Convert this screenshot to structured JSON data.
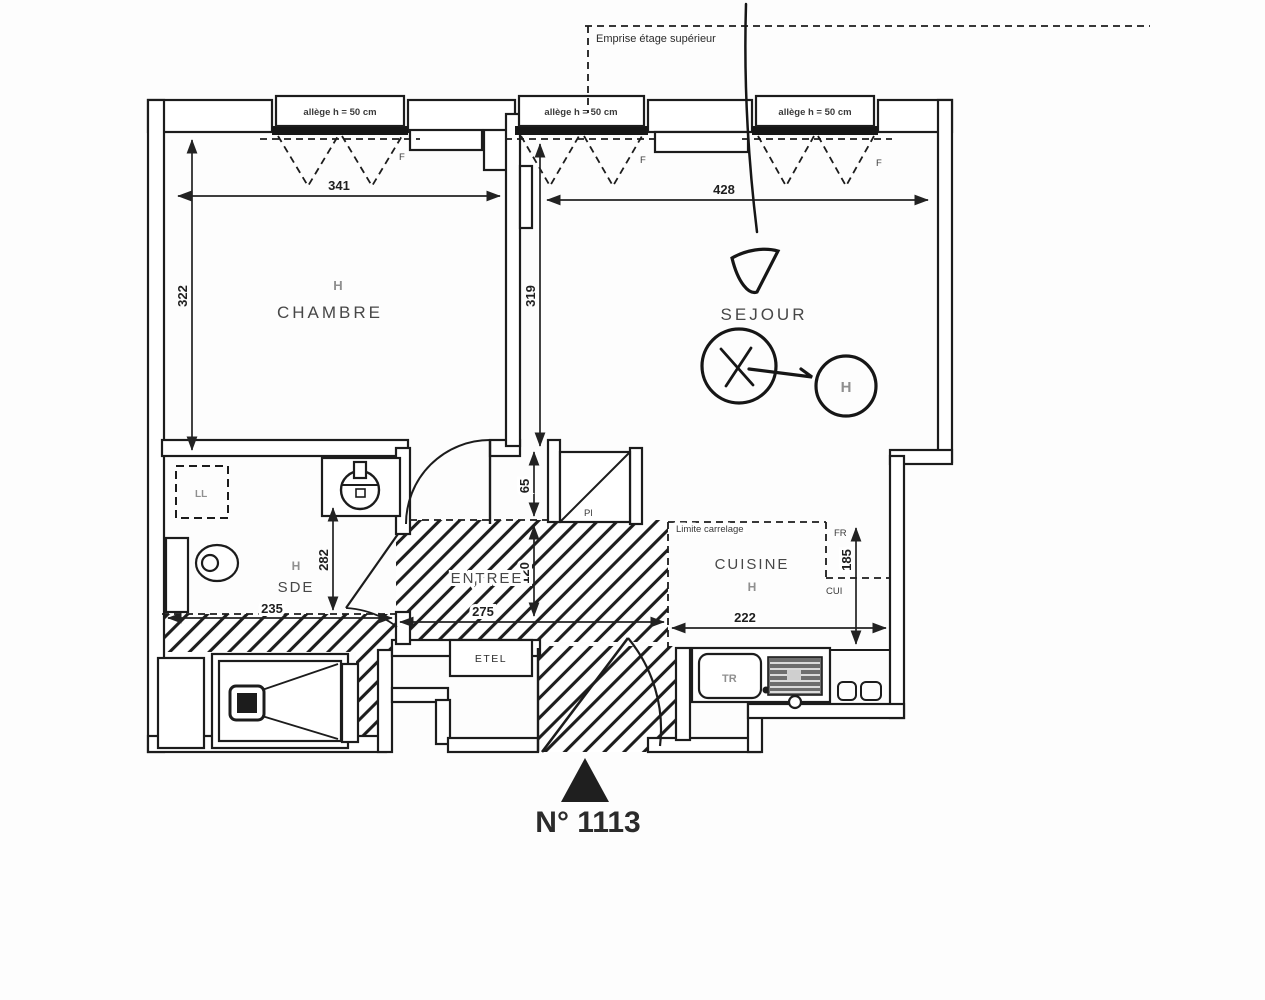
{
  "title": "N° 1113",
  "annotations": {
    "emprise": "Emprise étage supérieur",
    "sill": "allège h = 50 cm",
    "limite_carrelage": "Limite carrelage",
    "window_mark": "F"
  },
  "rooms": {
    "chambre": {
      "label": "CHAMBRE"
    },
    "sejour": {
      "label": "SEJOUR"
    },
    "sde": {
      "label": "SDE"
    },
    "entree": {
      "label": "ENTREE"
    },
    "cuisine": {
      "label": "CUISINE"
    }
  },
  "fixtures": {
    "etel": "ETEL",
    "fridge": "FR",
    "cooker": "CUI",
    "sink": "TR",
    "closet": "Pl",
    "washer": "LL"
  },
  "symbols": {
    "radiator": "H"
  },
  "dimensions": {
    "chambre_width": "341",
    "sejour_width": "428",
    "chambre_height": "322",
    "sejour_height": "319",
    "sde_height": "282",
    "closet_height": "65",
    "entree_depth": "120",
    "sde_width": "235",
    "entree_width": "275",
    "cuisine_width": "222",
    "cuisine_height": "185"
  },
  "colors": {
    "ink": "#1c1c1c",
    "faded": "#8f8f8f"
  }
}
